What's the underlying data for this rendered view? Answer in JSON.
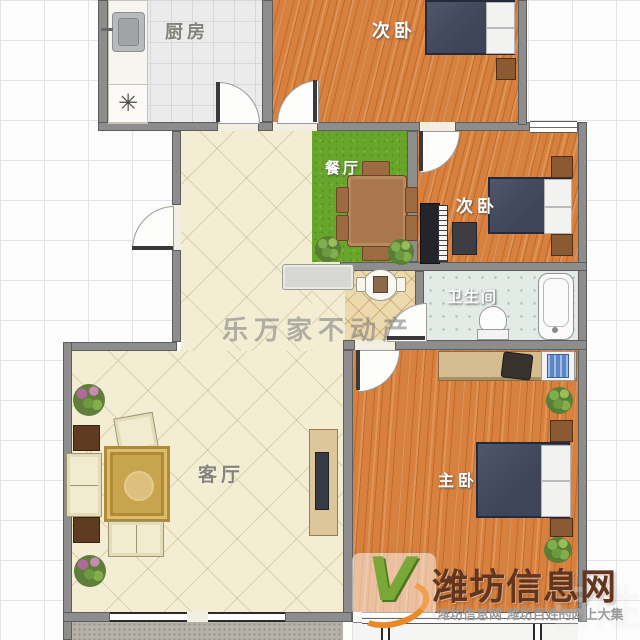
{
  "floorplan": {
    "rooms": {
      "kitchen": {
        "label": "厨房"
      },
      "bedroom_top": {
        "label": "次卧"
      },
      "dining": {
        "label": "餐厅"
      },
      "bedroom_mid": {
        "label": "次卧"
      },
      "bathroom": {
        "label": "卫生间"
      },
      "living": {
        "label": "客厅"
      },
      "master": {
        "label": "主卧"
      }
    },
    "icons": {
      "stove": "✳"
    },
    "colors": {
      "wall": "#8d8d8d",
      "wood_floor": "#d8813f",
      "grass_floor": "#68a52b",
      "hall_floor": "#f3edd3",
      "bath_floor": "#e2ebe6",
      "kitchen_floor": "#ebebec",
      "balcony_floor": "#b6b2a9",
      "bed": "#3e4459",
      "rug": "#c9a44e"
    }
  },
  "watermarks": {
    "agency": "乐万家不动产",
    "site_logo_letter": "V",
    "site_title": "潍坊信息网",
    "site_tagline": "潍坊信息网 潍坊百姓的网上大集",
    "site_faint": "百姓"
  }
}
